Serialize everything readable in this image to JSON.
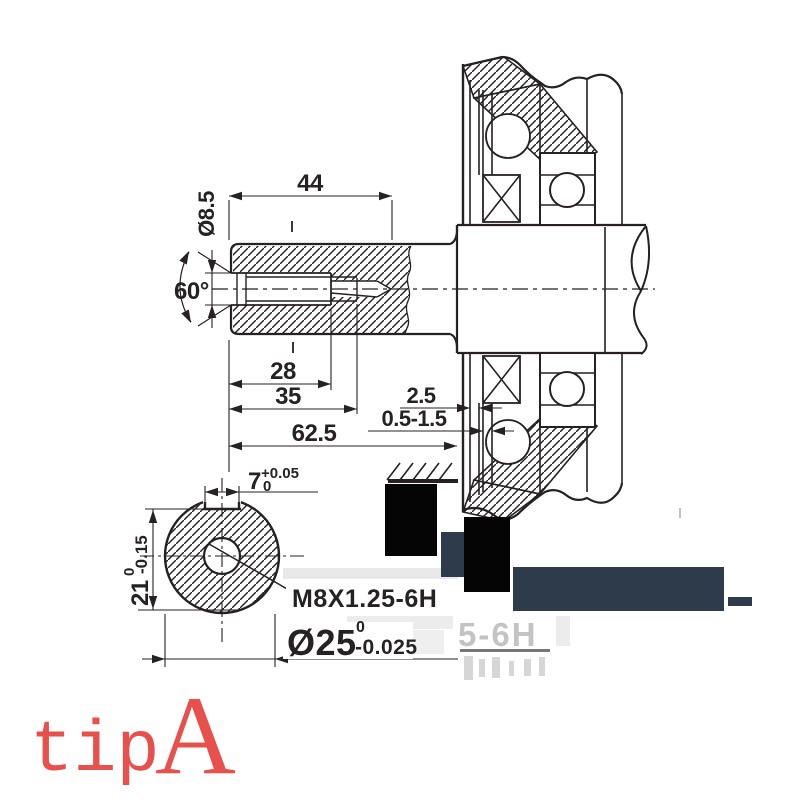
{
  "drawing": {
    "caption": {
      "prefix": "tip",
      "letter": "A"
    },
    "dims": {
      "len44": "44",
      "dia85": "Ø8.5",
      "ang60": "60°",
      "len28": "28",
      "len35": "35",
      "len625": "62.5",
      "gap25": "2.5",
      "gap0515": "0.5-1.5",
      "key7": "7",
      "key7_up": "+0.05",
      "key7_low": "0",
      "h21": "21",
      "h21_up": "0",
      "h21_low": "-0.15",
      "thread": "M8X1.25-6H",
      "dia25": "Ø25",
      "dia25_up": "0",
      "dia25_low": "-0.025"
    },
    "ghost_label": "5-6H",
    "colors": {
      "ink": "#262122",
      "caption_red": "#e8514b",
      "redaction_black": "#050505",
      "redaction_slate": "#2d3b4a",
      "ghost_gray": "#a0a0a0"
    }
  }
}
